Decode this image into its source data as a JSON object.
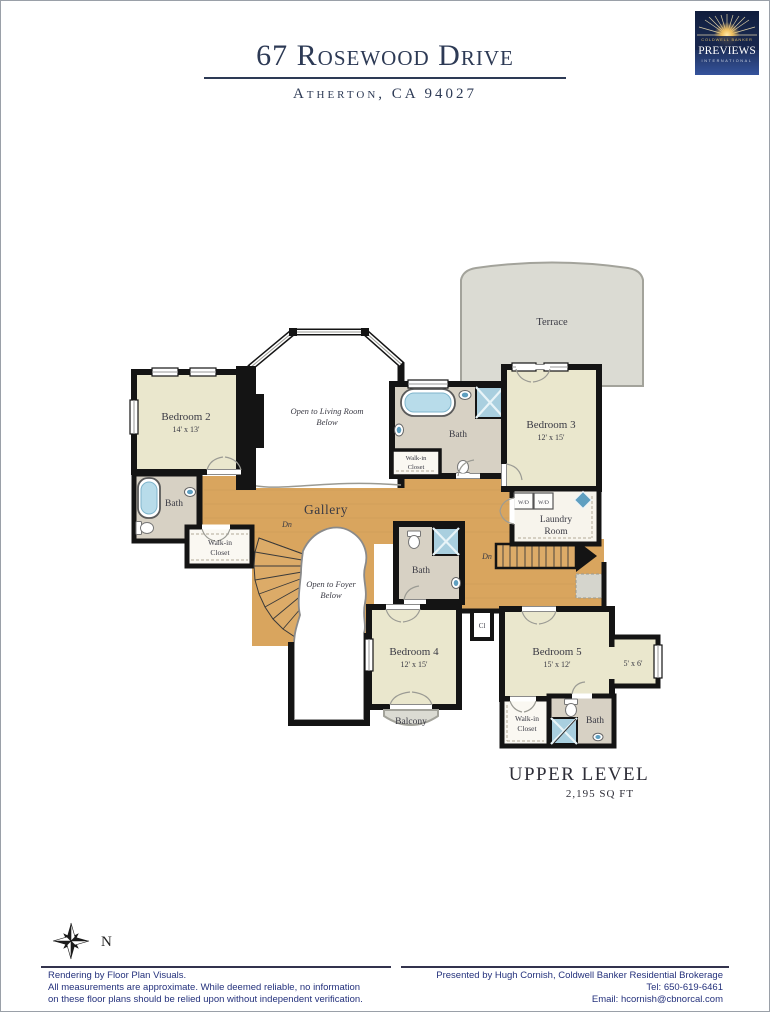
{
  "header": {
    "title": "67 Rosewood Drive",
    "subtitle": "Atherton, CA 94027"
  },
  "logo": {
    "brand": "COLDWELL BANKER",
    "name": "PREVIEWS",
    "tagline": "INTERNATIONAL"
  },
  "plan": {
    "level": "UPPER LEVEL",
    "area": "2,195 SQ FT",
    "rooms": {
      "bedroom2": {
        "name": "Bedroom 2",
        "dims": "14' x 13'"
      },
      "bedroom3": {
        "name": "Bedroom 3",
        "dims": "12' x 15'"
      },
      "bedroom4": {
        "name": "Bedroom 4",
        "dims": "12' x 15'"
      },
      "bedroom5": {
        "name": "Bedroom 5",
        "dims": "15' x 12'"
      }
    },
    "labels": {
      "terrace": "Terrace",
      "gallery": "Gallery",
      "balcony": "Balcony",
      "open_living_1": "Open to Living Room",
      "open_living_2": "Below",
      "open_foyer_1": "Open to Foyer",
      "open_foyer_2": "Below",
      "laundry_1": "Laundry",
      "laundry_2": "Room",
      "bath_nw": "Bath",
      "bath_n": "Bath",
      "bath_s": "Bath",
      "bath_se": "Bath",
      "walkin_w_1": "Walk-in",
      "walkin_w_2": "Closet",
      "walkin_n_1": "Walk-in",
      "walkin_n_2": "Closet",
      "walkin_s_1": "Walk-in",
      "walkin_s_2": "Closet",
      "dn_curved": "Dn",
      "dn_back": "Dn",
      "cl": "Cl",
      "alcove": "5' x 6'",
      "wd_left": "W/D",
      "wd_right": "W/D"
    }
  },
  "compass": {
    "north": "N"
  },
  "footer": {
    "left_1": "Rendering by Floor Plan Visuals.",
    "left_2": "All measurements are approximate. While deemed reliable, no information",
    "left_3": "on these floor plans should be relied upon without independent verification.",
    "right_1": "Presented by Hugh Cornish, Coldwell Banker Residential Brokerage",
    "right_2": "Tel: 650-619-6461",
    "right_3": "Email: hcornish@cbnorcal.com"
  },
  "colors": {
    "accent_navy": "#2d3a55",
    "footer_navy": "#24317c",
    "wall_black": "#141414",
    "wood_floor": "#d9a55e",
    "bedroom_fill": "#eae7cd",
    "bath_fill": "#d7d1c4",
    "terrace_gray": "#dbdbd3",
    "water_blue": "#9cc7dc"
  }
}
